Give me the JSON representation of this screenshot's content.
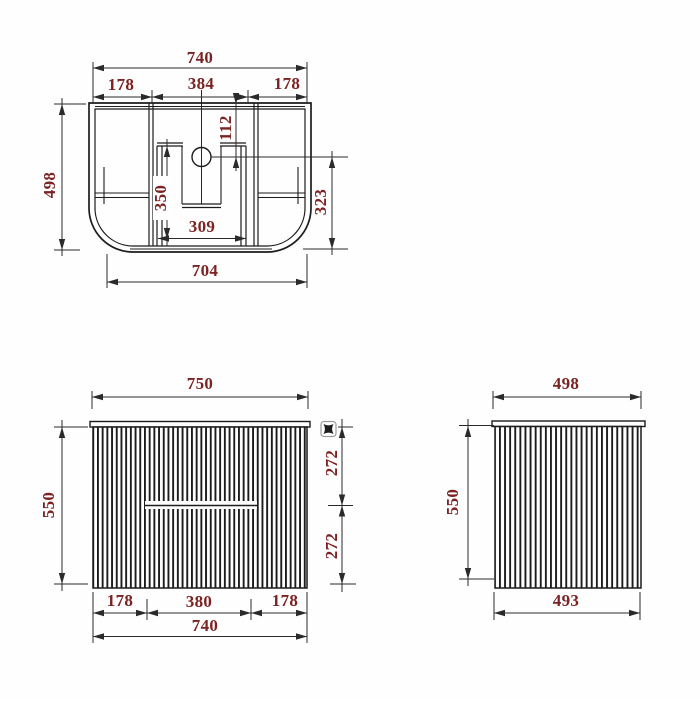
{
  "colors": {
    "line": "#1c1c1c",
    "dim_text": "#7b2222",
    "icon_border": "#9a9a9a"
  },
  "views": {
    "top": {
      "name": "top-view-plan",
      "dims": {
        "overall_width": "740",
        "left_section": "178",
        "center_section": "384",
        "right_section": "178",
        "hole_to_back": "112",
        "overall_depth": "498",
        "cutout_length": "350",
        "cutout_width": "309",
        "hole_to_front": "323",
        "base_width": "704"
      }
    },
    "front": {
      "name": "front-view",
      "dims": {
        "top_width": "750",
        "height": "550",
        "upper_half": "272",
        "lower_half": "272",
        "bottom_left": "178",
        "bottom_center": "380",
        "bottom_right": "178",
        "cabinet_width": "740"
      }
    },
    "side": {
      "name": "side-view",
      "dims": {
        "top_depth": "498",
        "height": "550",
        "body_depth": "493"
      }
    }
  },
  "icons": {
    "corner_marker": "pincushion-handle"
  }
}
